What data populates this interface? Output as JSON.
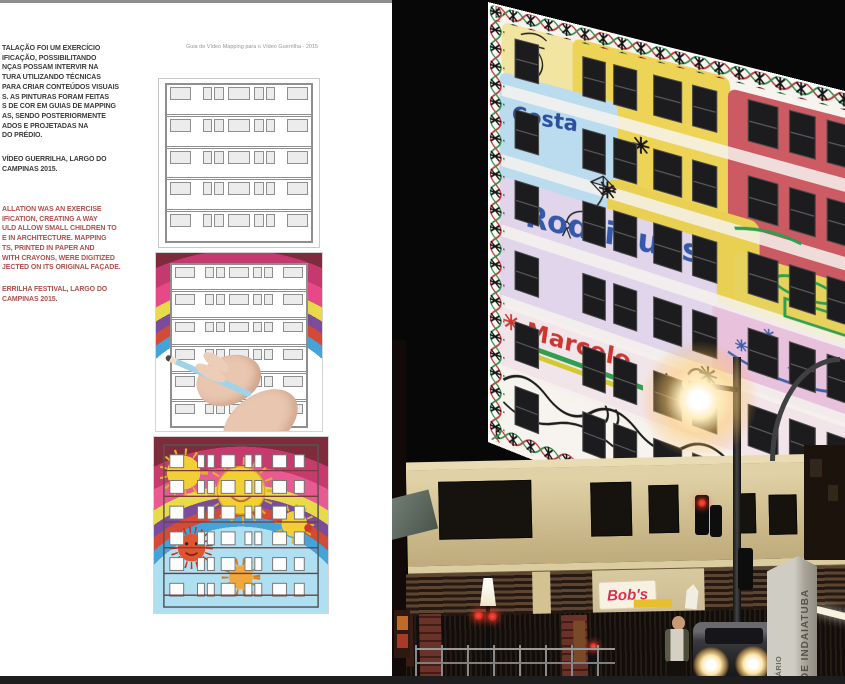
{
  "page": {
    "caption": "Guia de Vídeo Mapping para o Vídeo Guerrilha - 2015",
    "body_pt": {
      "lines": [
        "TALAÇÃO FOI UM EXERCÍCIO",
        "IFICAÇÃO, POSSIBILITANDO",
        "NÇAS POSSAM INTERVIR NA",
        "TURA UTILIZANDO TÉCNICAS",
        "PARA CRIAR CONTEÚDOS VISUAIS",
        "S. AS PINTURAS FORAM FEITAS",
        "S DE COR EM GUIAS DE MAPPING",
        "AS, SENDO POSTERIORMENTE",
        "ADOS E PROJETADAS NA",
        "DO PRÉDIO."
      ],
      "credit": [
        "VÍDEO GUERRILHA, LARGO DO",
        "CAMPINAS 2015."
      ]
    },
    "body_en": {
      "lines": [
        "ALLATION WAS AN EXERCISE",
        "IFICATION, CREATING A WAY",
        "ULD ALLOW SMALL CHILDREN TO",
        "E IN ARCHITECTURE. MAPPING",
        "TS, PRINTED IN PAPER AND",
        "WITH CRAYONS, WERE DIGITIZED",
        "JECTED ON ITS ORIGINAL FAÇADE."
      ],
      "credit": [
        "ERRILHA FESTIVAL, LARGO DO",
        "CAMPINAS 2015."
      ]
    }
  },
  "photo": {
    "facade": {
      "word_costa": "Costa",
      "word_rodrigues": "Rodrigues",
      "word_marcelo": "Marcelo"
    },
    "storefront_sign": "Bob's",
    "street_sign": {
      "line1": "DE INDAIATUBA",
      "line2": "SÁRIO"
    }
  },
  "colors": {
    "en_text_red": "#b0504c",
    "pt_text_gray": "#3b3b3b",
    "caption_gray": "#979797",
    "facade_yellow": "#edd24b",
    "facade_red": "#c84f58",
    "facade_blue": "#b6dbee",
    "facade_lavender": "#dfd3ea",
    "facade_pink": "#e7bedb",
    "bobs_red": "#d8304a",
    "sign_gray": "#cfccc4",
    "bottom_bar": "#1e1e1e"
  }
}
